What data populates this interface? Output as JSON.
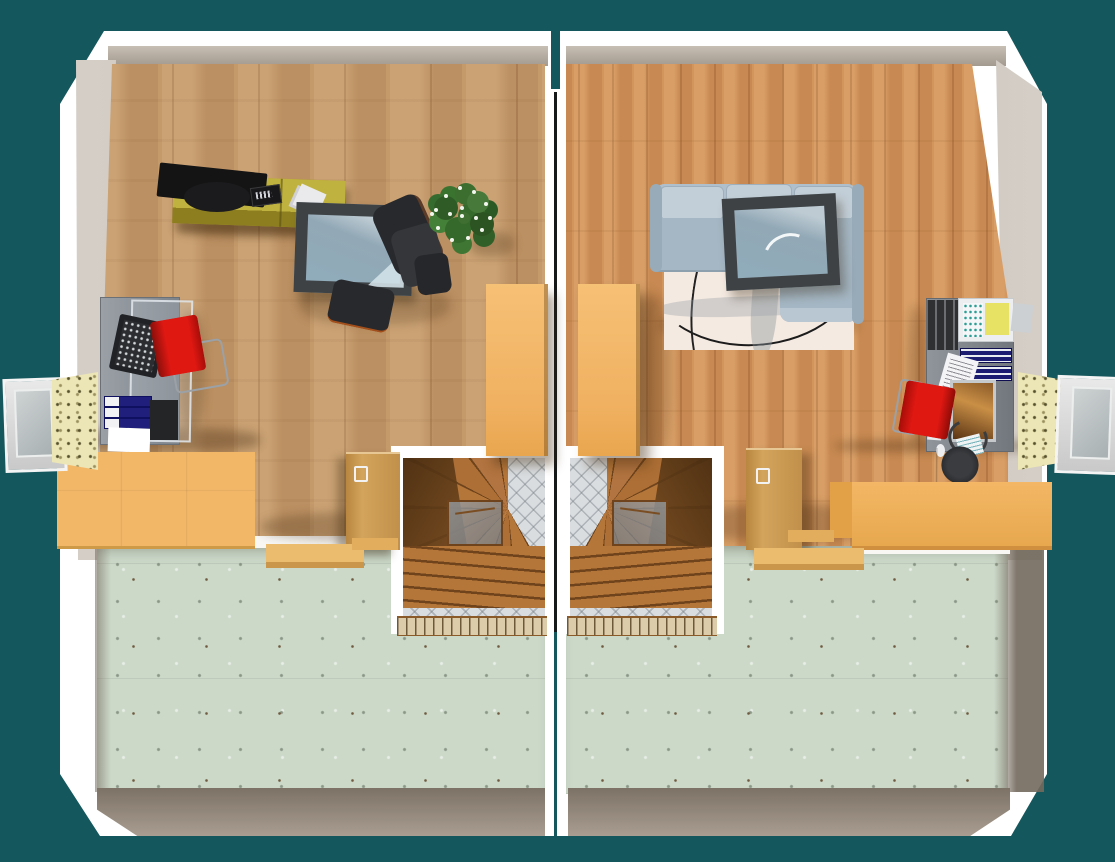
{
  "scene": {
    "type": "3d-top-down-floor-plan",
    "description": "Top-down 3D render of a mirrored semi-detached attic storey with twin winder staircases, desks, beds and wardrobes",
    "background_color": "#14575d",
    "units_count": 2
  },
  "palette": {
    "wall_white": "#ffffff",
    "inner_wall": "#b0a79c",
    "knee_wall_taupe": "#8a7f73",
    "wood_left": "#c49a6b",
    "wood_right": "#d2955c",
    "attic_green": "#ccd9c9",
    "furniture_orange": "#f3b768",
    "accent_red": "#cf1a10",
    "sofa_gray": "#a5b7c4",
    "tv_stand_olive": "#b3a12f",
    "table_frame": "#3e4245",
    "glass_blue": "#9db2bf",
    "stair_wood": "#b5763a",
    "black_furniture": "#28292c",
    "window_sill_speckle": "#ece5b5"
  },
  "units": [
    {
      "id": "left-unit",
      "side": "left",
      "wood_color": "#c49a6b",
      "furniture": [
        "tv-lowboard",
        "flat-screen-tv",
        "remote-control",
        "papers",
        "glass-coffee-table",
        "black-lounge-chair",
        "black-ottoman",
        "potted-plant",
        "tall-wardrobe",
        "computer-desk",
        "laptop",
        "red-desk-chair",
        "document-binders",
        "bed-chest",
        "wood-partition-door",
        "step-bench",
        "winder-staircase",
        "dormer-window"
      ]
    },
    {
      "id": "right-unit",
      "side": "right",
      "wood_color": "#d2955c",
      "furniture": [
        "corner-sofa",
        "area-rug",
        "glass-coffee-table",
        "tall-wardrobe",
        "computer-desk",
        "monitor",
        "keyboard",
        "red-desk-chair",
        "document-binders",
        "yellow-notepad",
        "double-bed-red",
        "wood-partition-door",
        "step-bench",
        "winder-staircase",
        "dormer-window"
      ]
    }
  ]
}
